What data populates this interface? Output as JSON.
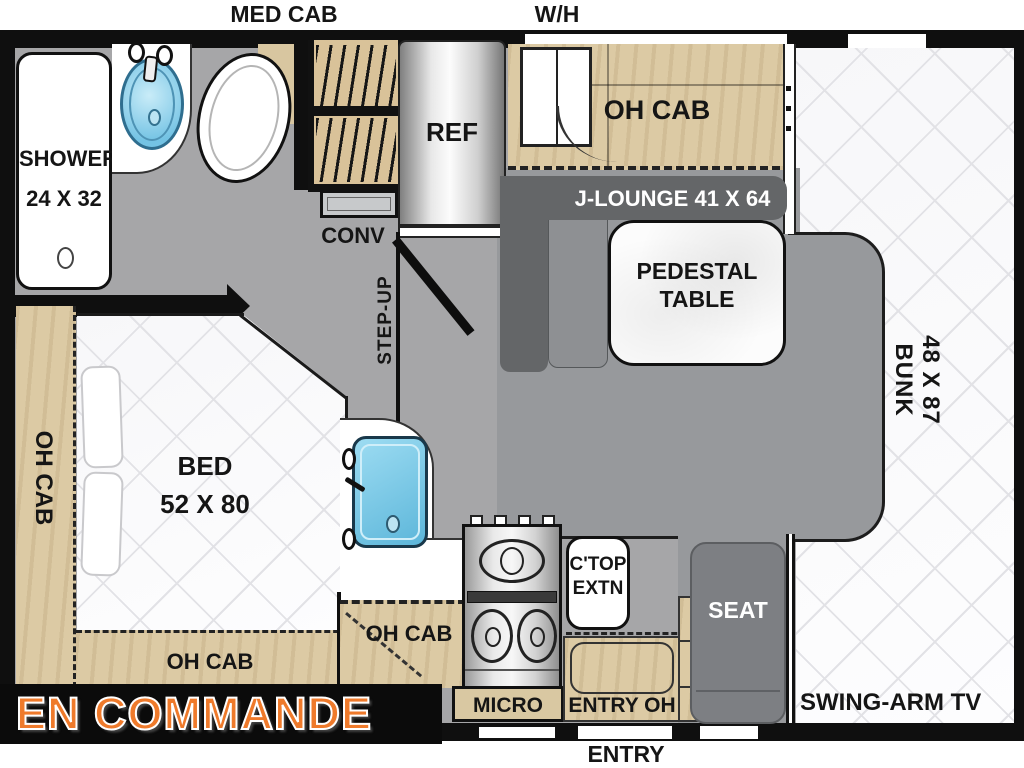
{
  "status_banner": {
    "text": "EN COMMANDE",
    "text_color": "#EF7A2B",
    "bg_color": "#0B0B0B"
  },
  "exterior_labels": {
    "med_cab": "MED CAB",
    "water_heater": "W/H",
    "entry": "ENTRY"
  },
  "bathroom": {
    "shower_label": "SHOWER",
    "shower_size": "24 X 32"
  },
  "kitchen": {
    "refrigerator": "REF",
    "convection": "CONV",
    "overhead_cab": "OH CAB",
    "microwave": "MICRO",
    "countertop_extension_line1": "C'TOP",
    "countertop_extension_line2": "EXTN",
    "entry_overhead": "ENTRY OH"
  },
  "living": {
    "j_lounge": "J-LOUNGE 41 X 64",
    "pedestal_table_line1": "PEDESTAL",
    "pedestal_table_line2": "TABLE",
    "overhead_cab": "OH CAB",
    "step_up": "STEP-UP",
    "seat": "SEAT",
    "swing_arm_tv": "SWING-ARM TV"
  },
  "bedroom": {
    "bed_label": "BED",
    "bed_size": "52 X 80",
    "overhead_cab_left": "OH CAB",
    "overhead_cab_rear": "OH CAB"
  },
  "bunk": {
    "size": "48 X 87",
    "label": "BUNK"
  },
  "colors": {
    "wall": "#0F0F0F",
    "floor": "#A6A6A8",
    "cab_floor": "#97999C",
    "wood_cabinet": "#DCCAA4",
    "lounge_gray": "#646668",
    "seat_gray": "#7D7F83",
    "sink_blue": "#74C3E4",
    "mattress_quilt": "#FBFBFC",
    "banner_orange": "#EF7A2B"
  }
}
